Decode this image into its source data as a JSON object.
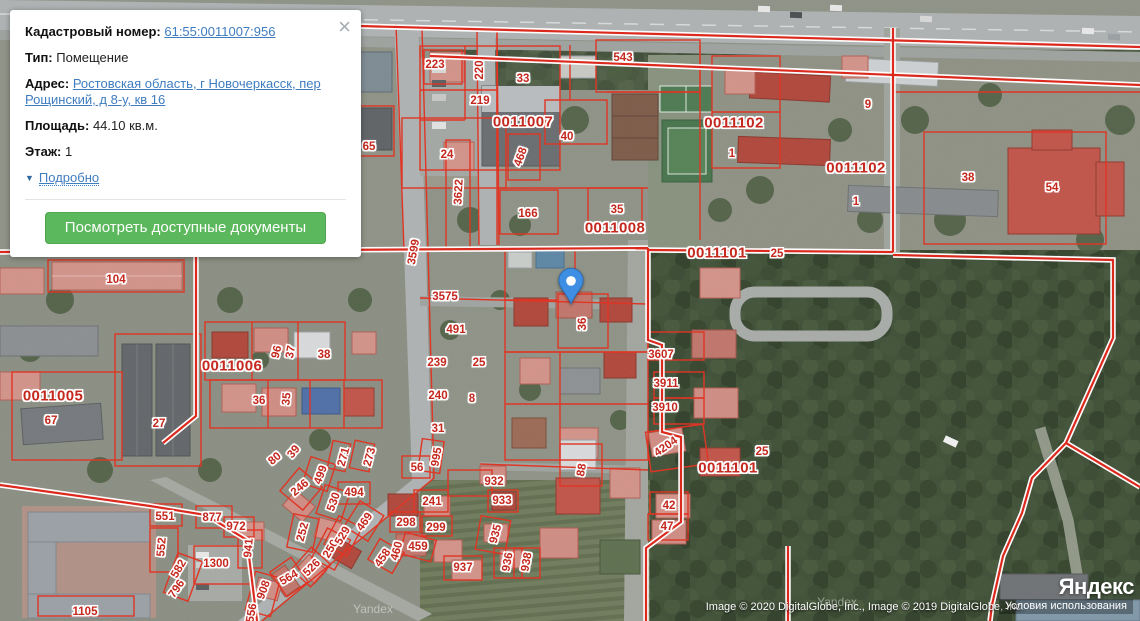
{
  "popup": {
    "close_icon": "×",
    "fields": {
      "cadastral": {
        "label": "Кадастровый номер:",
        "value": "61:55:0011007:956"
      },
      "type": {
        "label": "Тип:",
        "value": "Помещение"
      },
      "address": {
        "label": "Адрес:",
        "value": "Ростовская область, г Новочеркасск, пер Рощинский, д 8-у, кв 16"
      },
      "area": {
        "label": "Площадь:",
        "value": "44.10 кв.м."
      },
      "floor": {
        "label": "Этаж:",
        "value": "1"
      }
    },
    "details_toggle": {
      "icon": "▼",
      "label": "Подробно"
    },
    "action_button": "Посмотреть доступные документы"
  },
  "map": {
    "marker": {
      "x": 571,
      "y": 306
    },
    "quarter_labels": [
      {
        "t": "0011007",
        "x": 523,
        "y": 122
      },
      {
        "t": "0011008",
        "x": 615,
        "y": 228
      },
      {
        "t": "0011101",
        "x": 717,
        "y": 253
      },
      {
        "t": "0011102",
        "x": 734,
        "y": 123
      },
      {
        "t": "0011102",
        "x": 856,
        "y": 168
      },
      {
        "t": "0011101",
        "x": 728,
        "y": 468
      },
      {
        "t": "0011006",
        "x": 232,
        "y": 366
      },
      {
        "t": "0011005",
        "x": 53,
        "y": 396
      }
    ],
    "parcel_labels": [
      {
        "t": "223",
        "x": 435,
        "y": 65
      },
      {
        "t": "220",
        "x": 480,
        "y": 70,
        "r": -90
      },
      {
        "t": "219",
        "x": 480,
        "y": 101
      },
      {
        "t": "33",
        "x": 523,
        "y": 79
      },
      {
        "t": "543",
        "x": 623,
        "y": 58
      },
      {
        "t": "40",
        "x": 567,
        "y": 137
      },
      {
        "t": "24",
        "x": 447,
        "y": 155
      },
      {
        "t": "65",
        "x": 369,
        "y": 147
      },
      {
        "t": "468",
        "x": 521,
        "y": 157,
        "r": -70
      },
      {
        "t": "3622",
        "x": 459,
        "y": 192,
        "r": -87
      },
      {
        "t": "166",
        "x": 528,
        "y": 214
      },
      {
        "t": "35",
        "x": 617,
        "y": 210
      },
      {
        "t": "9",
        "x": 868,
        "y": 105
      },
      {
        "t": "1",
        "x": 732,
        "y": 154
      },
      {
        "t": "1",
        "x": 856,
        "y": 202
      },
      {
        "t": "38",
        "x": 968,
        "y": 178
      },
      {
        "t": "54",
        "x": 1052,
        "y": 188
      },
      {
        "t": "25",
        "x": 777,
        "y": 254
      },
      {
        "t": "3599",
        "x": 414,
        "y": 252,
        "r": -80
      },
      {
        "t": "3575",
        "x": 445,
        "y": 297
      },
      {
        "t": "491",
        "x": 456,
        "y": 330
      },
      {
        "t": "36",
        "x": 583,
        "y": 324,
        "r": -90
      },
      {
        "t": "3607",
        "x": 661,
        "y": 355
      },
      {
        "t": "3911",
        "x": 666,
        "y": 384
      },
      {
        "t": "3910",
        "x": 665,
        "y": 408
      },
      {
        "t": "4204",
        "x": 666,
        "y": 447,
        "r": -35
      },
      {
        "t": "25",
        "x": 762,
        "y": 452
      },
      {
        "t": "104",
        "x": 116,
        "y": 280
      },
      {
        "t": "239",
        "x": 437,
        "y": 363
      },
      {
        "t": "25",
        "x": 479,
        "y": 363
      },
      {
        "t": "240",
        "x": 438,
        "y": 396
      },
      {
        "t": "8",
        "x": 472,
        "y": 399
      },
      {
        "t": "31",
        "x": 438,
        "y": 429
      },
      {
        "t": "995",
        "x": 437,
        "y": 457,
        "r": -80
      },
      {
        "t": "96",
        "x": 277,
        "y": 352,
        "r": -75
      },
      {
        "t": "37",
        "x": 291,
        "y": 352,
        "r": -80
      },
      {
        "t": "38",
        "x": 324,
        "y": 355
      },
      {
        "t": "36",
        "x": 259,
        "y": 401
      },
      {
        "t": "35",
        "x": 287,
        "y": 399,
        "r": -85
      },
      {
        "t": "67",
        "x": 51,
        "y": 421
      },
      {
        "t": "27",
        "x": 159,
        "y": 424
      },
      {
        "t": "80",
        "x": 275,
        "y": 459,
        "r": -40
      },
      {
        "t": "39",
        "x": 294,
        "y": 452,
        "r": -50
      },
      {
        "t": "271",
        "x": 344,
        "y": 457,
        "r": -75
      },
      {
        "t": "273",
        "x": 370,
        "y": 457,
        "r": -75
      },
      {
        "t": "56",
        "x": 417,
        "y": 468
      },
      {
        "t": "551",
        "x": 165,
        "y": 517
      },
      {
        "t": "552",
        "x": 162,
        "y": 547,
        "r": -85
      },
      {
        "t": "582",
        "x": 179,
        "y": 569,
        "r": -60
      },
      {
        "t": "796",
        "x": 177,
        "y": 589,
        "r": -55
      },
      {
        "t": "877",
        "x": 212,
        "y": 518
      },
      {
        "t": "972",
        "x": 236,
        "y": 527
      },
      {
        "t": "1300",
        "x": 216,
        "y": 564
      },
      {
        "t": "1105",
        "x": 85,
        "y": 612
      },
      {
        "t": "941",
        "x": 249,
        "y": 548,
        "r": -85
      },
      {
        "t": "908",
        "x": 264,
        "y": 590,
        "r": -70
      },
      {
        "t": "556",
        "x": 252,
        "y": 613,
        "r": -80
      },
      {
        "t": "246",
        "x": 300,
        "y": 488,
        "r": -40
      },
      {
        "t": "252",
        "x": 303,
        "y": 532,
        "r": -75
      },
      {
        "t": "250",
        "x": 331,
        "y": 549,
        "r": -60
      },
      {
        "t": "530",
        "x": 334,
        "y": 502,
        "r": -70
      },
      {
        "t": "529",
        "x": 343,
        "y": 536,
        "r": -60
      },
      {
        "t": "526",
        "x": 312,
        "y": 568,
        "r": -45
      },
      {
        "t": "564",
        "x": 289,
        "y": 578,
        "r": -30
      },
      {
        "t": "494",
        "x": 354,
        "y": 493
      },
      {
        "t": "469",
        "x": 365,
        "y": 522,
        "r": -55
      },
      {
        "t": "499",
        "x": 321,
        "y": 475,
        "r": -70
      },
      {
        "t": "241",
        "x": 432,
        "y": 502
      },
      {
        "t": "298",
        "x": 406,
        "y": 523
      },
      {
        "t": "299",
        "x": 436,
        "y": 528
      },
      {
        "t": "459",
        "x": 418,
        "y": 547
      },
      {
        "t": "460",
        "x": 397,
        "y": 551,
        "r": -75
      },
      {
        "t": "458",
        "x": 383,
        "y": 558,
        "r": -55
      },
      {
        "t": "932",
        "x": 494,
        "y": 482
      },
      {
        "t": "933",
        "x": 502,
        "y": 501
      },
      {
        "t": "935",
        "x": 496,
        "y": 534,
        "r": -75
      },
      {
        "t": "936",
        "x": 508,
        "y": 562,
        "r": -80
      },
      {
        "t": "937",
        "x": 463,
        "y": 568
      },
      {
        "t": "938",
        "x": 527,
        "y": 562,
        "r": -80
      },
      {
        "t": "88",
        "x": 582,
        "y": 470,
        "r": -80
      },
      {
        "t": "42",
        "x": 669,
        "y": 506
      },
      {
        "t": "47",
        "x": 667,
        "y": 527
      }
    ],
    "watermarks": [
      {
        "t": "Yandex",
        "x": 373,
        "y": 609
      },
      {
        "t": "Yandex",
        "x": 837,
        "y": 602
      }
    ],
    "attribution": "Image © 2020 DigitalGlobe, Inc., Image © 2019 DigitalGlobe, Inc.",
    "terms_link": "Условия использования",
    "brand_logo": "Яндекс"
  },
  "colors": {
    "cadastral_red": "#dd2418",
    "label_red": "#c4281e",
    "link_blue": "#3f7dc0",
    "button_green": "#5cb85c",
    "pin_blue": "#3e8ee3"
  }
}
